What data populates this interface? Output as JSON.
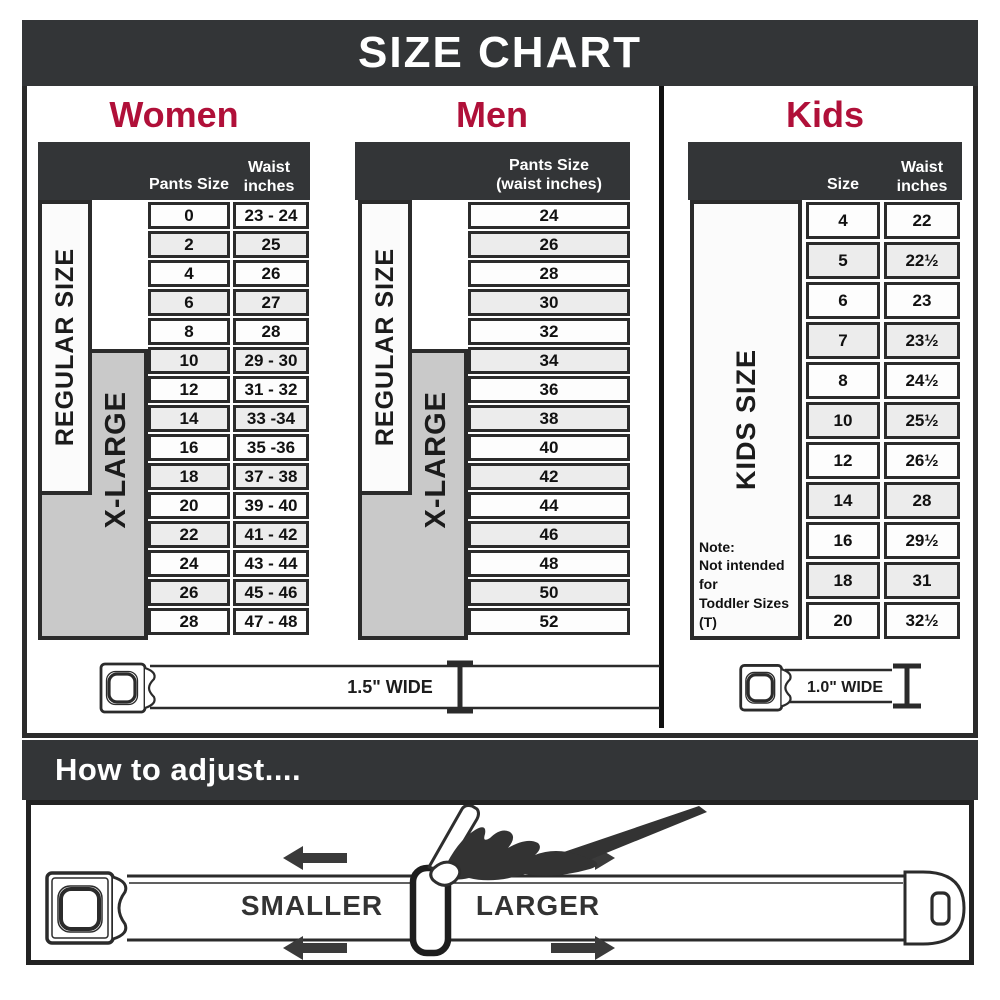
{
  "title": "SIZE CHART",
  "colors": {
    "banner": "#333537",
    "accent_red": "#b01039",
    "row_alt": "#ececec",
    "xlarge_gray": "#c9c9c9"
  },
  "women": {
    "heading": "Women",
    "col1_header": "Pants Size",
    "col2_header": "Waist inches",
    "regular_label": "REGULAR SIZE",
    "xlarge_label": "X-LARGE",
    "belt_width": "1.5\" WIDE",
    "rows": [
      [
        "0",
        "23 - 24"
      ],
      [
        "2",
        "25"
      ],
      [
        "4",
        "26"
      ],
      [
        "6",
        "27"
      ],
      [
        "8",
        "28"
      ],
      [
        "10",
        "29 - 30"
      ],
      [
        "12",
        "31 - 32"
      ],
      [
        "14",
        "33 -34"
      ],
      [
        "16",
        "35 -36"
      ],
      [
        "18",
        "37 - 38"
      ],
      [
        "20",
        "39 - 40"
      ],
      [
        "22",
        "41 - 42"
      ],
      [
        "24",
        "43 - 44"
      ],
      [
        "26",
        "45 - 46"
      ],
      [
        "28",
        "47 - 48"
      ]
    ]
  },
  "men": {
    "heading": "Men",
    "col_header_line1": "Pants Size",
    "col_header_line2": "(waist inches)",
    "regular_label": "REGULAR SIZE",
    "xlarge_label": "X-LARGE",
    "rows": [
      "24",
      "26",
      "28",
      "30",
      "32",
      "34",
      "36",
      "38",
      "40",
      "42",
      "44",
      "46",
      "48",
      "50",
      "52"
    ]
  },
  "kids": {
    "heading": "Kids",
    "col1_header": "Size",
    "col2_header": "Waist inches",
    "size_label": "KIDS SIZE",
    "belt_width": "1.0\" WIDE",
    "note": [
      "Note:",
      "Not intended for",
      "Toddler Sizes (T)"
    ],
    "rows": [
      [
        "4",
        "22"
      ],
      [
        "5",
        "22½"
      ],
      [
        "6",
        "23"
      ],
      [
        "7",
        "23½"
      ],
      [
        "8",
        "24½"
      ],
      [
        "10",
        "25½"
      ],
      [
        "12",
        "26½"
      ],
      [
        "14",
        "28"
      ],
      [
        "16",
        "29½"
      ],
      [
        "18",
        "31"
      ],
      [
        "20",
        "32½"
      ]
    ]
  },
  "adjust": {
    "heading": "How to adjust....",
    "smaller_label": "SMALLER",
    "larger_label": "LARGER"
  }
}
